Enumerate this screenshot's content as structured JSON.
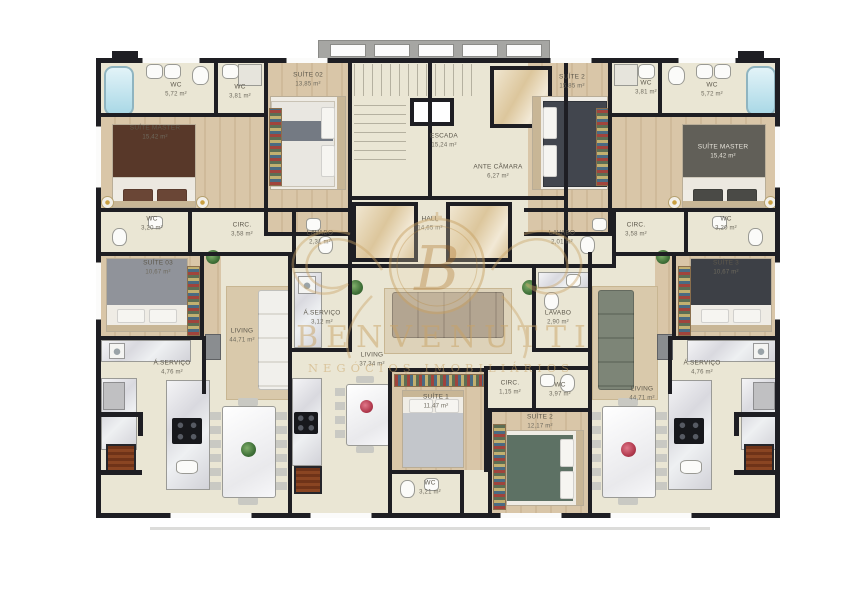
{
  "brand": {
    "name": "BENVENUTTI",
    "tagline": "NEGÓCIOS IMOBILIÁRIOS",
    "monogram": "B"
  },
  "common": {
    "escada": {
      "label": "ESCADA",
      "area": "15,24 m²"
    },
    "ante_camara": {
      "label": "ANTE CÂMARA",
      "area": "6,27 m²"
    },
    "hall": {
      "label": "HALL",
      "area": "14,65 m²"
    }
  },
  "units": {
    "left": {
      "wc_master": {
        "label": "WC",
        "area": "5,72 m²"
      },
      "wc_suite": {
        "label": "WC",
        "area": "3,81 m²"
      },
      "suite_02": {
        "label": "SUÍTE 02",
        "area": "13,85 m²"
      },
      "suite_master": {
        "label": "SUÍTE MASTER",
        "area": "15,42 m²"
      },
      "wc_master2": {
        "label": "WC",
        "area": "3,20 m²"
      },
      "circ": {
        "label": "CIRC.",
        "area": "3,58 m²"
      },
      "lavabo": {
        "label": "LAVABO",
        "area": "2,31 m²"
      },
      "suite_03": {
        "label": "SUÍTE 03",
        "area": "10,67 m²"
      },
      "servico": {
        "label": "Á.SERVIÇO",
        "area": "4,76 m²"
      },
      "living": {
        "label": "LIVING",
        "area": "44,71 m²"
      }
    },
    "center": {
      "servico": {
        "label": "Á.SERVIÇO",
        "area": "3,12 m²"
      },
      "living": {
        "label": "LIVING",
        "area": "37,34 m²"
      },
      "lavabo": {
        "label": "LAVABO",
        "area": "2,90 m²"
      },
      "circ": {
        "label": "CIRC.",
        "area": "1,15 m²"
      },
      "wc": {
        "label": "WC",
        "area": "3,97 m²"
      },
      "suite_1": {
        "label": "SUÍTE 1",
        "area": "11,47 m²"
      },
      "wc_suite1": {
        "label": "WC",
        "area": "3,21 m²"
      },
      "suite_2": {
        "label": "SUÍTE 2",
        "area": "12,17 m²"
      }
    },
    "right": {
      "wc_suite": {
        "label": "WC",
        "area": "3,81 m²"
      },
      "wc_master": {
        "label": "WC",
        "area": "5,72 m²"
      },
      "suite_2": {
        "label": "SUÍTE 2",
        "area": "15,85 m²"
      },
      "suite_master": {
        "label": "SUÍTE MASTER",
        "area": "15,42 m²"
      },
      "wc_master2": {
        "label": "WC",
        "area": "3,20 m²"
      },
      "circ": {
        "label": "CIRC.",
        "area": "3,58 m²"
      },
      "lavabo": {
        "label": "LAVABO",
        "area": "2,01 m²"
      },
      "suite_3": {
        "label": "SUÍTE 3",
        "area": "10,67 m²"
      },
      "servico": {
        "label": "Á.SERVIÇO",
        "area": "4,76 m²"
      },
      "living": {
        "label": "LIVING",
        "area": "44,71 m²"
      }
    }
  },
  "colors": {
    "wall": "#1e1e23",
    "floor": "#eae6d4",
    "wood": "#d9c6a8",
    "marble": "#e9e9ec",
    "accent_gold": "#c9a365",
    "bathtub": "#a9d8e6",
    "grill": "#7b3a1c"
  }
}
